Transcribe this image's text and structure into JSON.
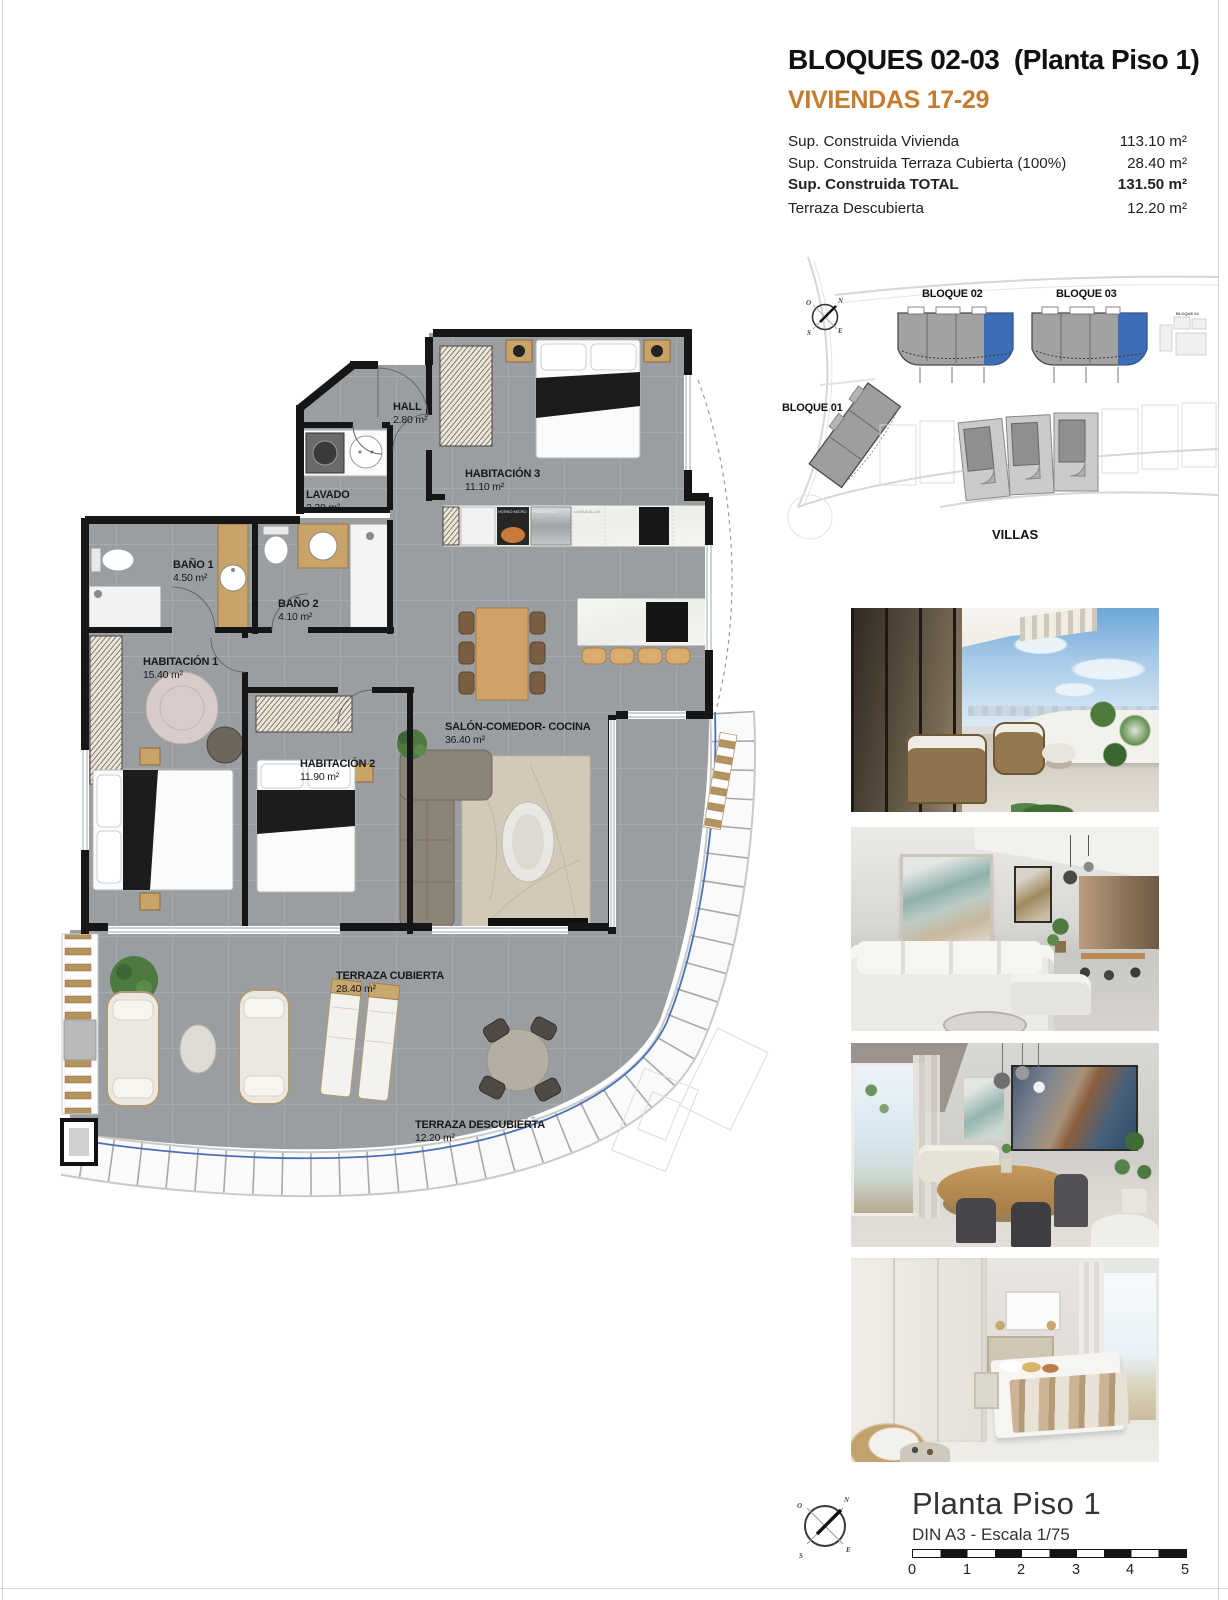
{
  "header": {
    "title": "BLOQUES 02-03  (Planta Piso 1)",
    "subtitle": "VIVIENDAS 17-29",
    "area_rows": [
      {
        "label": "Sup. Construida Vivienda",
        "value": "113.10 m²"
      },
      {
        "label": "Sup. Construida Terraza Cubierta (100%)",
        "value": "28.40 m²"
      },
      {
        "label": "Sup. Construida TOTAL",
        "value": "131.50 m²"
      },
      {
        "label": "Terraza Descubierta",
        "value": "12.20 m²"
      }
    ]
  },
  "site_plan": {
    "bloque02": "BLOQUE 02",
    "bloque03": "BLOQUE 03",
    "bloque01": "BLOQUE 01",
    "bloque04": "BLOQUE 04",
    "villas": "VILLAS",
    "highlight_color": "#3d6db4"
  },
  "compass": {
    "n": "N",
    "e": "E",
    "s": "S",
    "o": "O"
  },
  "floor_plan": {
    "rooms": [
      {
        "name": "HALL",
        "area": "2.80 m²"
      },
      {
        "name": "LAVADO",
        "area": "2.20 m²"
      },
      {
        "name": "HABITACIÓN 3",
        "area": "11.10 m²"
      },
      {
        "name": "BAÑO 1",
        "area": "4.50 m²"
      },
      {
        "name": "BAÑO 2",
        "area": "4.10 m²"
      },
      {
        "name": "HABITACIÓN 1",
        "area": "15.40 m²"
      },
      {
        "name": "HABITACIÓN 2",
        "area": "11.90 m²"
      },
      {
        "name": "SALÓN-COMEDOR- COCINA",
        "area": "36.40 m²"
      },
      {
        "name": "TERRAZA CUBIERTA",
        "area": "28.40 m²"
      },
      {
        "name": "TERRAZA DESCUBIERTA",
        "area": "12.20 m²"
      }
    ],
    "appliances": {
      "oven": "HORNO MICRO",
      "fridge": "FRIGORIFICO",
      "dishwasher": "LAVAVAJILLAS"
    }
  },
  "footer": {
    "title": "Planta Piso 1",
    "scale_note": "DIN A3 - Escala 1/75",
    "ticks": [
      "0",
      "1",
      "2",
      "3",
      "4",
      "5"
    ]
  },
  "photos": [
    {
      "id": "terrace-view"
    },
    {
      "id": "living-room"
    },
    {
      "id": "dining-area"
    },
    {
      "id": "bedroom"
    }
  ],
  "colors": {
    "accent_orange": "#c67c2e",
    "highlight_blue": "#3d6db4",
    "wall": "#161616",
    "floor": "#9b9ea1",
    "boundary_blue": "#4b6fb8"
  }
}
